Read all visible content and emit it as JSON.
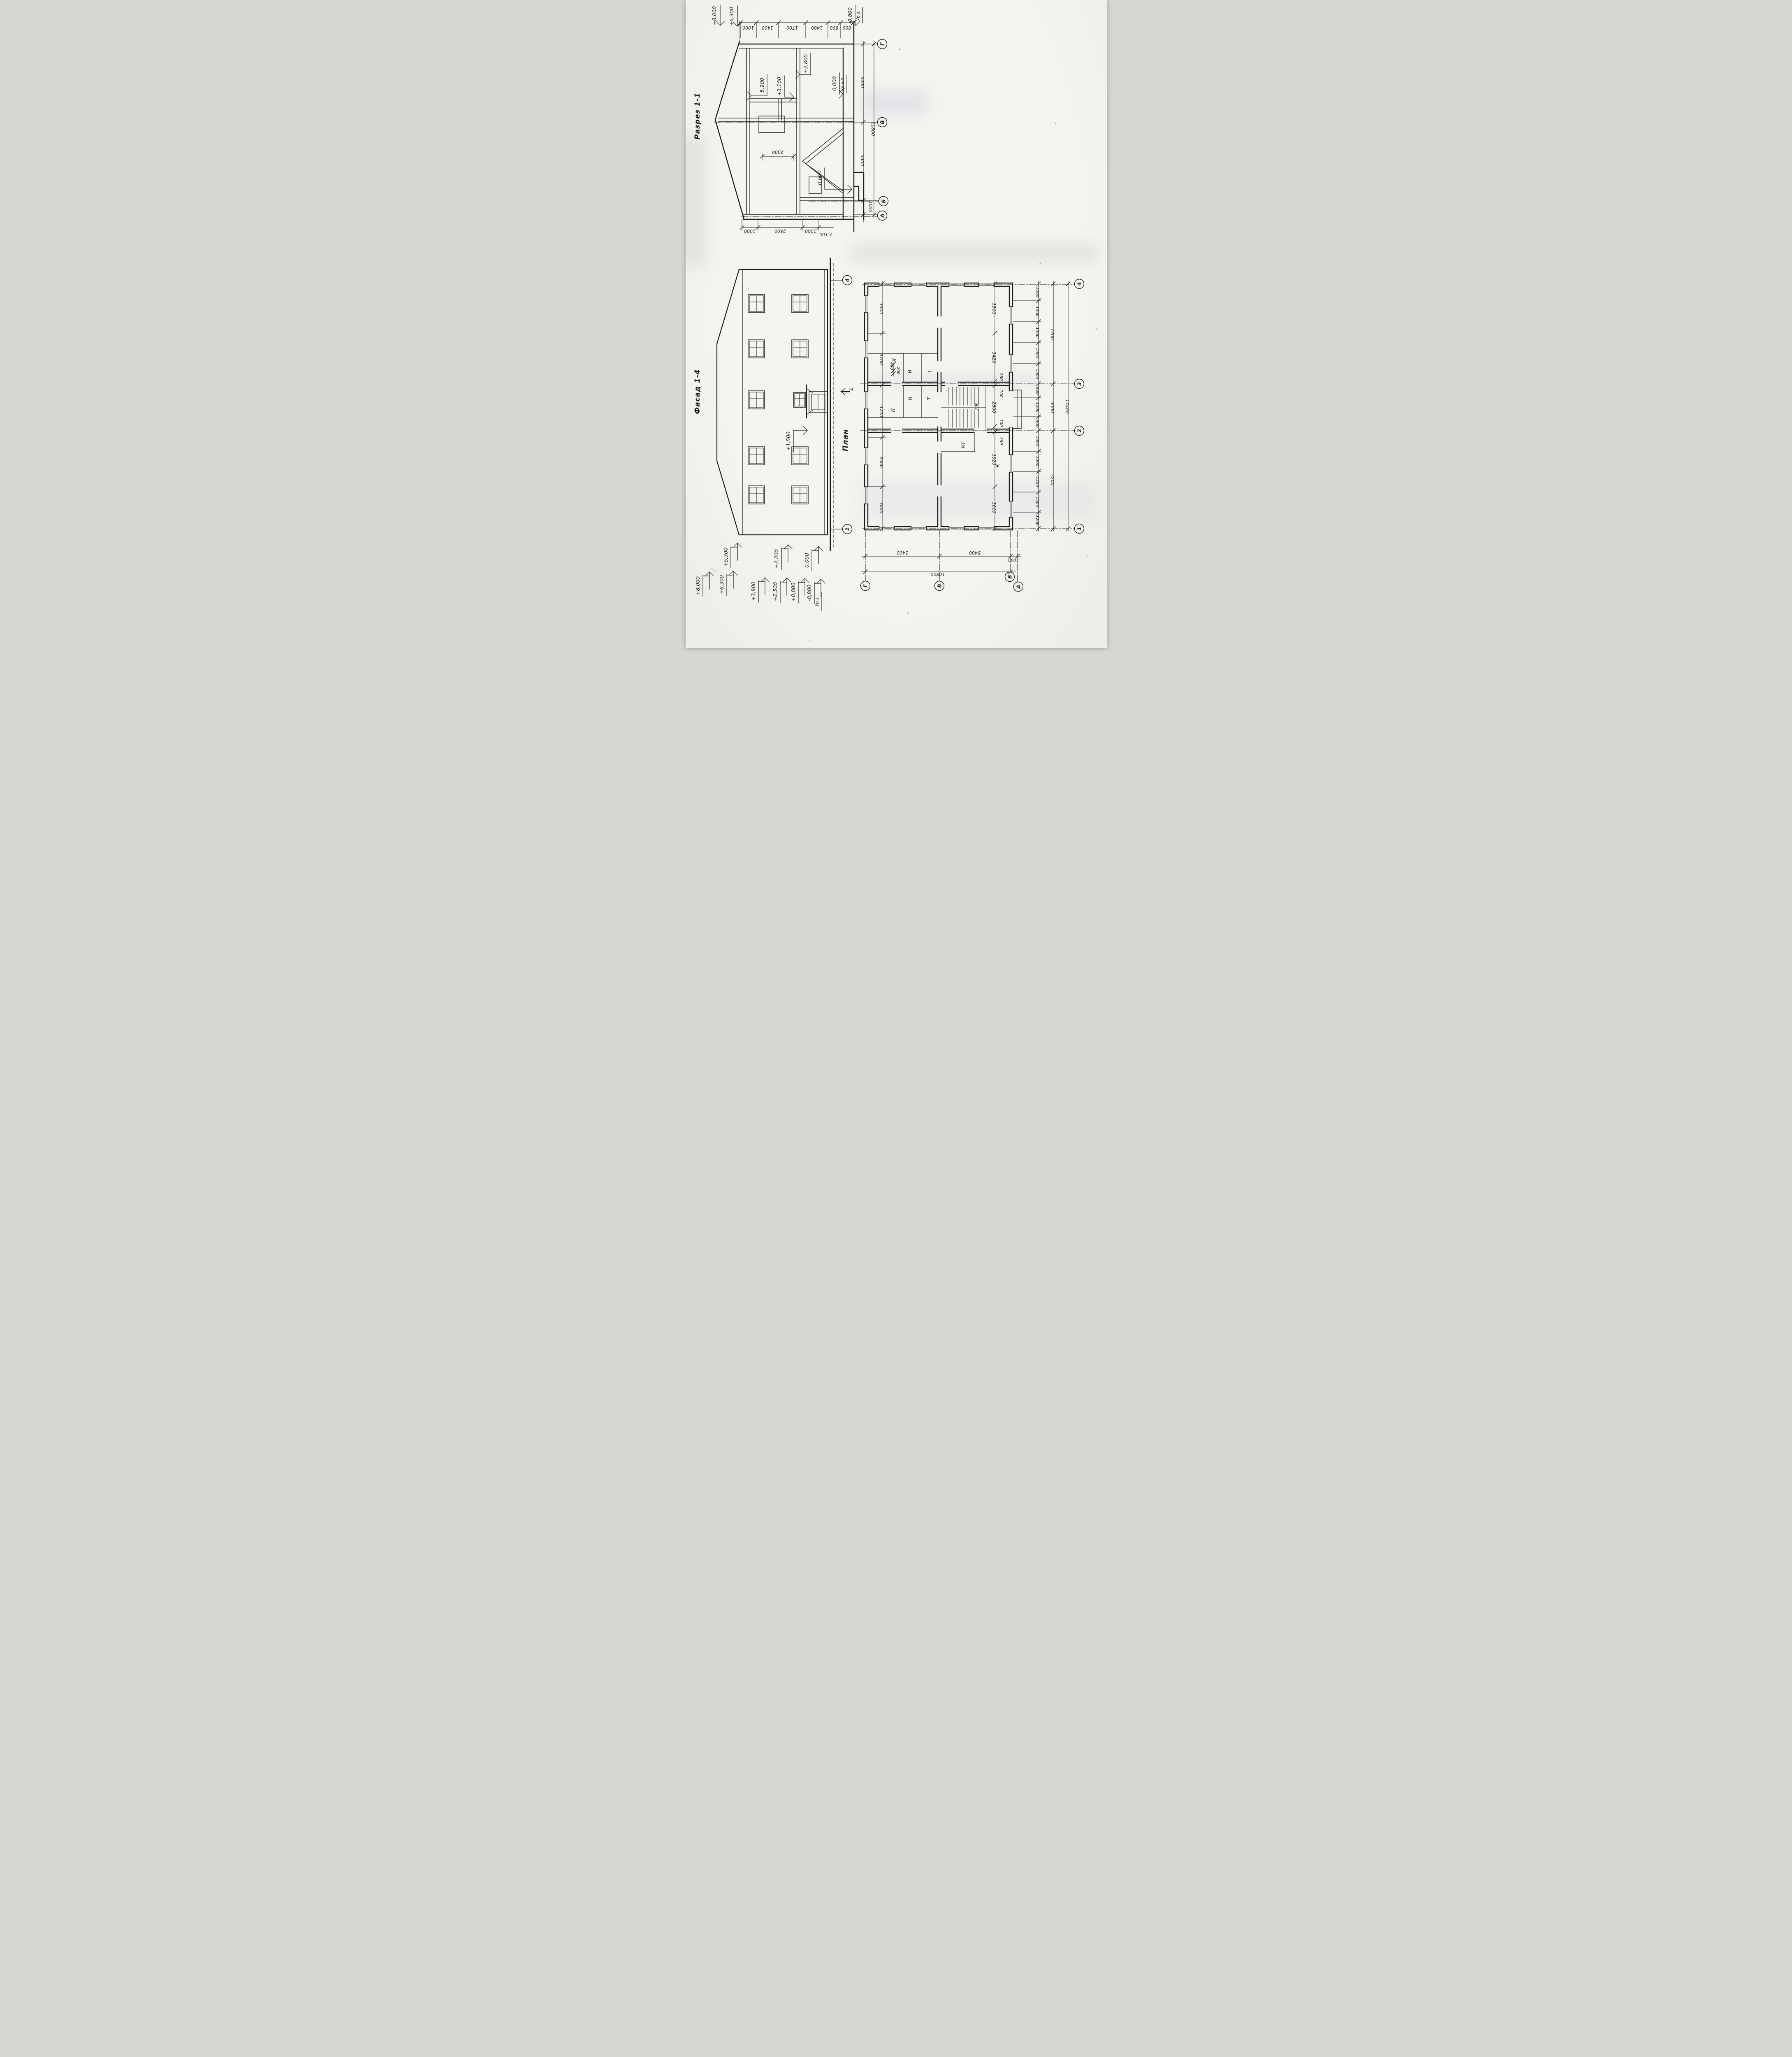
{
  "titles": {
    "section": "Разрез 1-1",
    "facade": "Фасад 1-4",
    "plan": "План"
  },
  "section": {
    "top_chain": [
      "1000",
      "1400",
      "1700",
      "1400",
      "800",
      "800"
    ],
    "p8000": "+8,000",
    "p6300": "+6,300",
    "m0800": "-0,800",
    "urz": "Ур.з.",
    "m5900": "5,900",
    "p3100": "+3,100",
    "p2800": "+2,800",
    "zero": "0,000",
    "urchp": "Ур.ч.п",
    "m0600": "-0,600",
    "d2000": "2000",
    "right": [
      "5400",
      "5400",
      "1000"
    ],
    "right_total": "11800",
    "bottom": [
      "1000",
      "2800",
      "1000"
    ],
    "bottom_extra": "2,100",
    "axes": [
      "Г",
      "В",
      "Б",
      "А"
    ]
  },
  "facade": {
    "m1500": "+1,500",
    "cut": "1",
    "axis_top": "4",
    "axis_bottom": "1",
    "row1": [
      "+8,000",
      "+6,300",
      "+3,900",
      "+2,500",
      "+0,800",
      "-0,800"
    ],
    "urz": "Ур.з.",
    "row2": [
      "+5,300",
      "+2,200",
      "0,000"
    ]
  },
  "plan": {
    "left_chain": [
      "3500",
      "3700",
      "3700",
      "3500",
      "3000"
    ],
    "inner_chain": [
      "3500",
      "3420",
      "280",
      "100",
      "2800",
      "100",
      "280",
      "3920",
      "3000"
    ],
    "small": [
      "440",
      "200"
    ],
    "rooms": {
      "k": "К",
      "v": "В",
      "t": "Т",
      "lk": "ЛК",
      "vt": "ВТ"
    },
    "chain1": [
      "1200",
      "1500",
      "1500",
      "1500",
      "1500",
      "900",
      "1200",
      "900",
      "1500",
      "1500",
      "1500",
      "1500",
      "1200"
    ],
    "chain2": [
      "7200",
      "3000",
      "7200"
    ],
    "total": "17400",
    "bottom": [
      "5400",
      "5400",
      "1000"
    ],
    "bottom_total": "10800",
    "axes_letters": [
      "Г",
      "В",
      "Б",
      "А"
    ],
    "axes_numbers": [
      "4",
      "3",
      "2",
      "1"
    ]
  }
}
